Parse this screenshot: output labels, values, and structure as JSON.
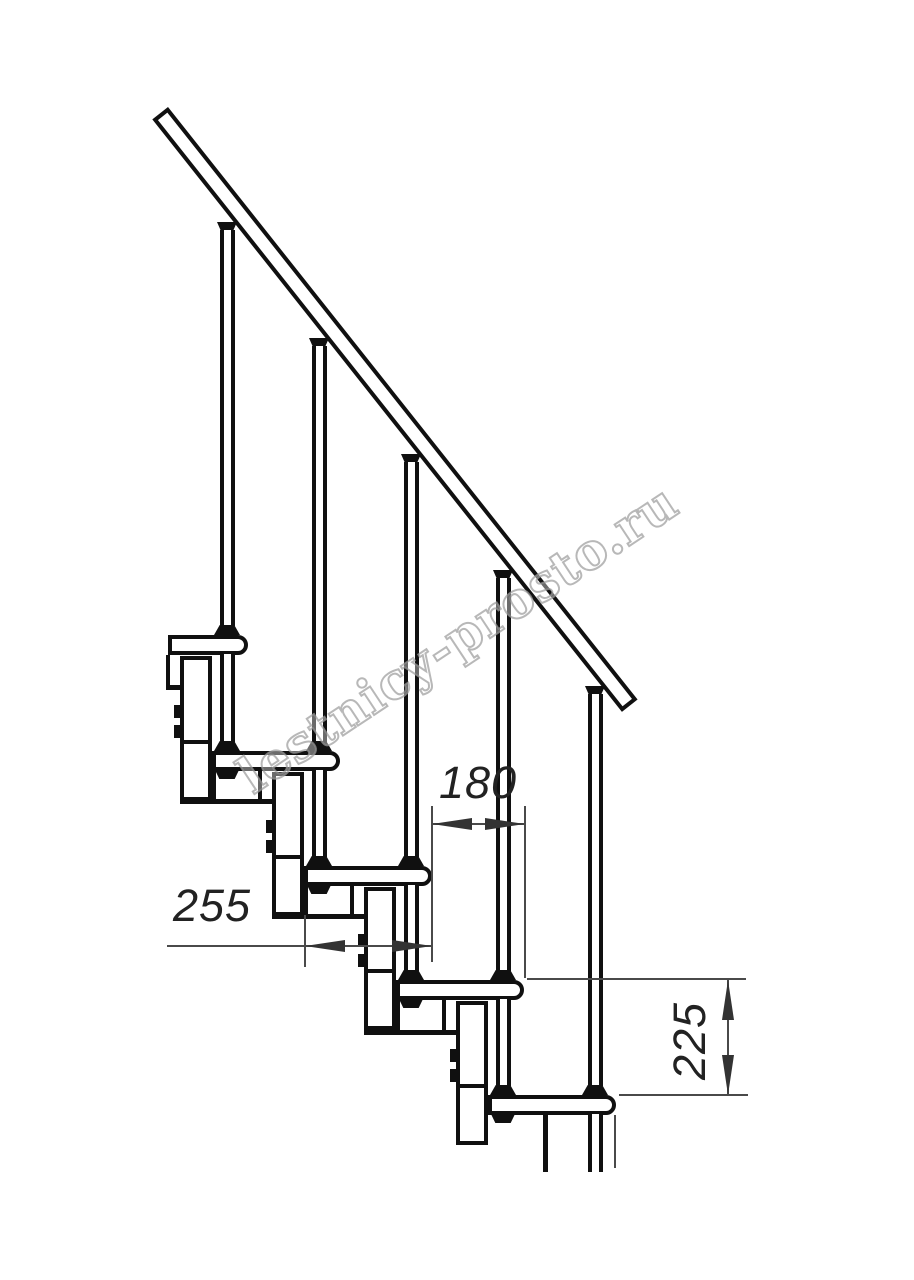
{
  "title": "Modular staircase fragment — technical side view drawing",
  "watermark": {
    "text": "lestnicy-prosto.ru",
    "outline_color": "#9e9e9e"
  },
  "dimensions": {
    "step_run": {
      "value": "180",
      "orientation": "horizontal",
      "measures": "distance between step nosings"
    },
    "tread_depth": {
      "value": "255",
      "orientation": "horizontal",
      "measures": "tread depth"
    },
    "step_rise": {
      "value": "225",
      "orientation": "vertical",
      "measures": "rise between treads"
    }
  },
  "drawing": {
    "background": "#ffffff",
    "line_color": "#101010",
    "dim_line_color": "#4a4a4a",
    "parts": [
      "handrail",
      "balusters",
      "treads",
      "support-modules",
      "bolts",
      "nuts"
    ]
  }
}
